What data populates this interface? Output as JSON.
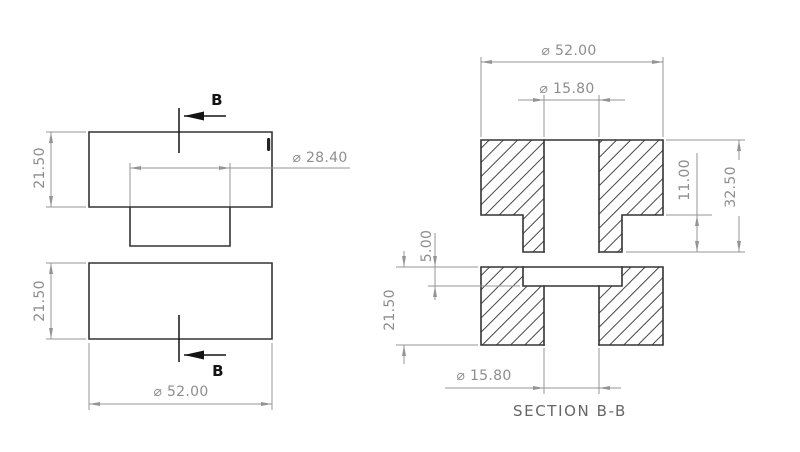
{
  "colors": {
    "edge": "#343434",
    "hatch": "#464646",
    "dim_line": "#949494",
    "dim_text": "#8d8d8d",
    "section_text": "#666666",
    "cut": "#141414"
  },
  "front_view": {
    "top_part": {
      "height": "21.50",
      "boss_diameter": "⌀ 28.40"
    },
    "bottom_part": {
      "height": "21.50",
      "diameter": "⌀ 52.00"
    },
    "cut_label_top": "B",
    "cut_label_bottom": "B"
  },
  "section_view": {
    "title": "SECTION B-B",
    "top_part": {
      "diameter": "⌀ 52.00",
      "hole_diameter": "⌀ 15.80",
      "boss_height": "11.00",
      "total_height": "32.50"
    },
    "bottom_part": {
      "recess_depth": "5.00",
      "height": "21.50",
      "hole_diameter": "⌀ 15.80"
    }
  }
}
